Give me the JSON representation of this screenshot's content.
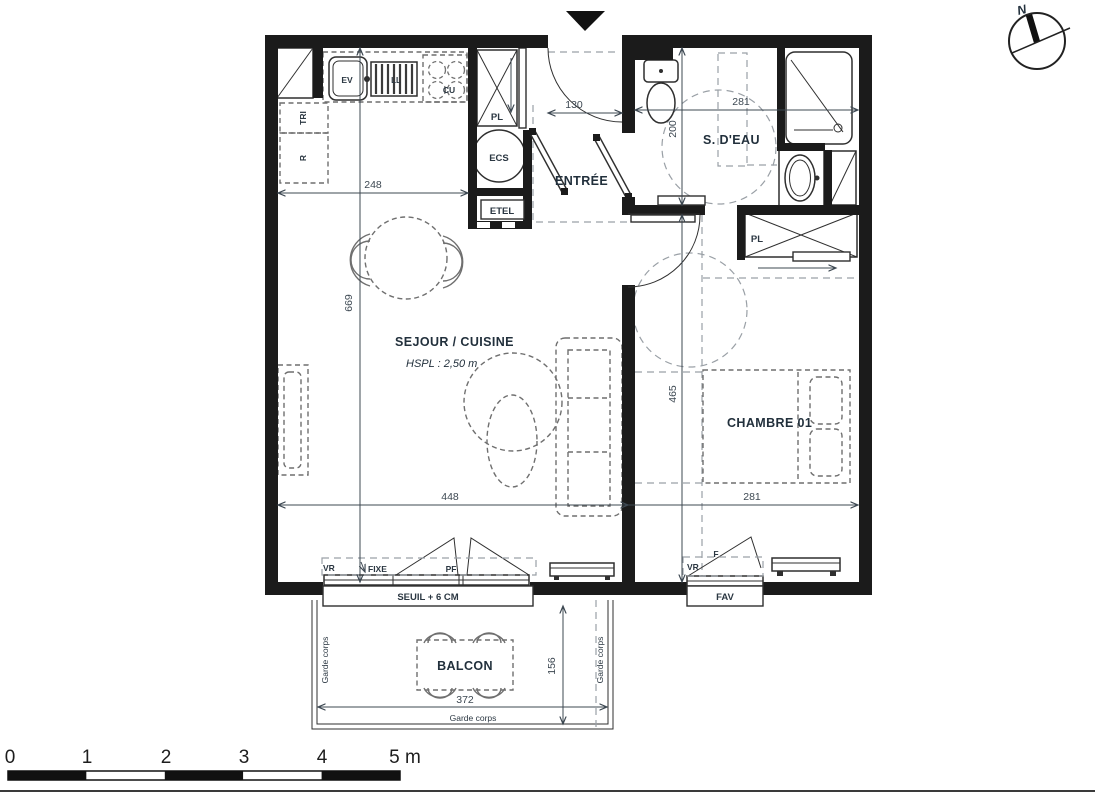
{
  "colors": {
    "wall": "#1b1b1b",
    "line": "#2f2f2f",
    "furniture_dash": "#6f6f6f",
    "zone_dash": "#9aa0a6",
    "text": "#22303c",
    "dim_text": "#3d4852"
  },
  "rooms": {
    "sejour_cuisine": {
      "label": "SEJOUR / CUISINE",
      "height_note": "HSPL : 2,50 m"
    },
    "chambre": {
      "label": "CHAMBRE 01"
    },
    "salle_eau": {
      "label": "S. D'EAU"
    },
    "entree": {
      "label": "ENTRÉE"
    },
    "balcon": {
      "label": "BALCON"
    }
  },
  "fixtures": {
    "closet_entree": "PL",
    "water_heater": "ECS",
    "electrical_panel": "ETEL",
    "waste_sorting": "TRI",
    "fridge": "R",
    "sink": "EV",
    "washer": "LL",
    "cooktop": "CU",
    "closet_chambre": "PL"
  },
  "openings": {
    "shutter_left": "VR",
    "fixed_pane": "FIXE",
    "french_door": "PF",
    "threshold": "SEUIL + 6 CM",
    "shutter_right": "VR",
    "window": "F",
    "vent_window": "FAV"
  },
  "balcony": {
    "railing": "Garde corps"
  },
  "dimensions": {
    "kitchen_width": "248",
    "sejour_depth": "669",
    "sejour_width": "448",
    "entree_width": "130",
    "salle_eau_width": "281",
    "salle_eau_depth": "200",
    "chambre_depth": "465",
    "chambre_width": "281",
    "balcon_width": "372",
    "balcon_depth": "156"
  },
  "scale_bar": {
    "ticks": [
      "0",
      "1",
      "2",
      "3",
      "4",
      "5 m"
    ]
  },
  "compass": {
    "north": "N"
  }
}
